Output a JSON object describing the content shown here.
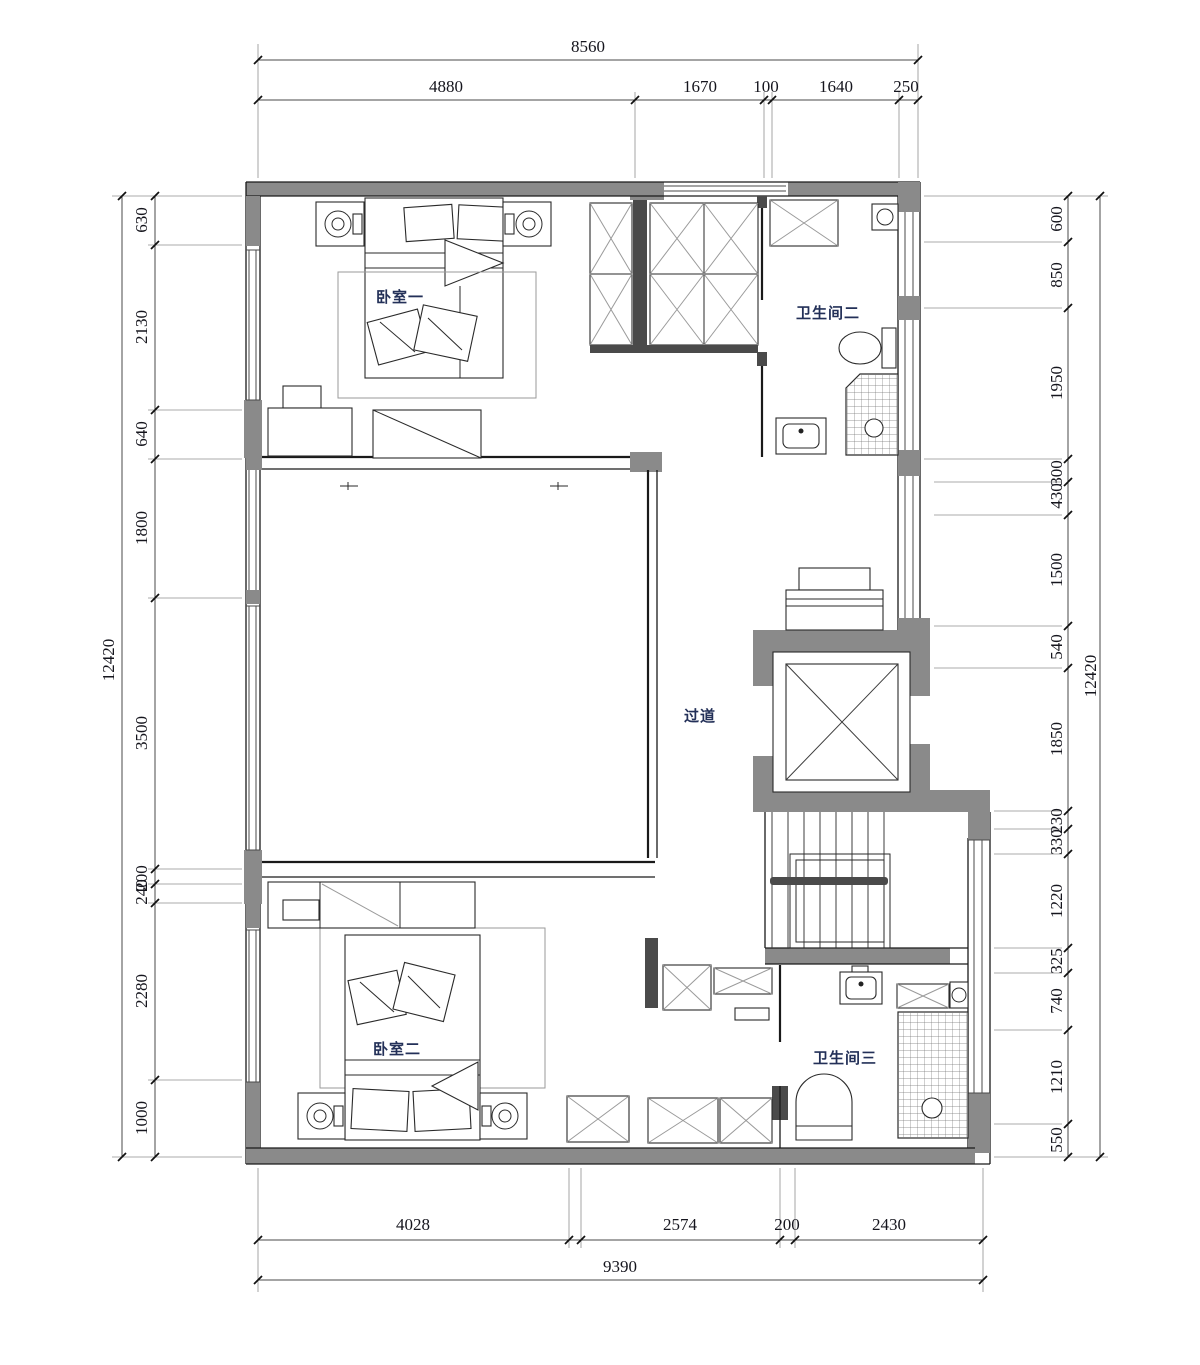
{
  "rooms": {
    "bedroom1": "卧室一",
    "bathroom2": "卫生间二",
    "hallway": "过道",
    "bedroom2": "卧室二",
    "bathroom3": "卫生间三"
  },
  "dims": {
    "top_total": "8560",
    "top_segments": [
      "4880",
      "1670",
      "100",
      "1640",
      "250"
    ],
    "bottom_segments": [
      "4028",
      "2574",
      "200",
      "2430"
    ],
    "bottom_total": "9390",
    "left_total": "12420",
    "left_segments": [
      "630",
      "2130",
      "640",
      "1800",
      "3500",
      "200",
      "240",
      "2280",
      "1000"
    ],
    "right_segments": [
      "600",
      "850",
      "1950",
      "300",
      "430",
      "1500",
      "540",
      "1850",
      "230",
      "330",
      "1220",
      "325",
      "740",
      "1210",
      "550"
    ],
    "right_total": "12420"
  },
  "colors": {
    "wall_gray": "#8a8a8a",
    "line": "#1a1a1a",
    "room_label": "#233058",
    "dim_text": "#15151d"
  }
}
